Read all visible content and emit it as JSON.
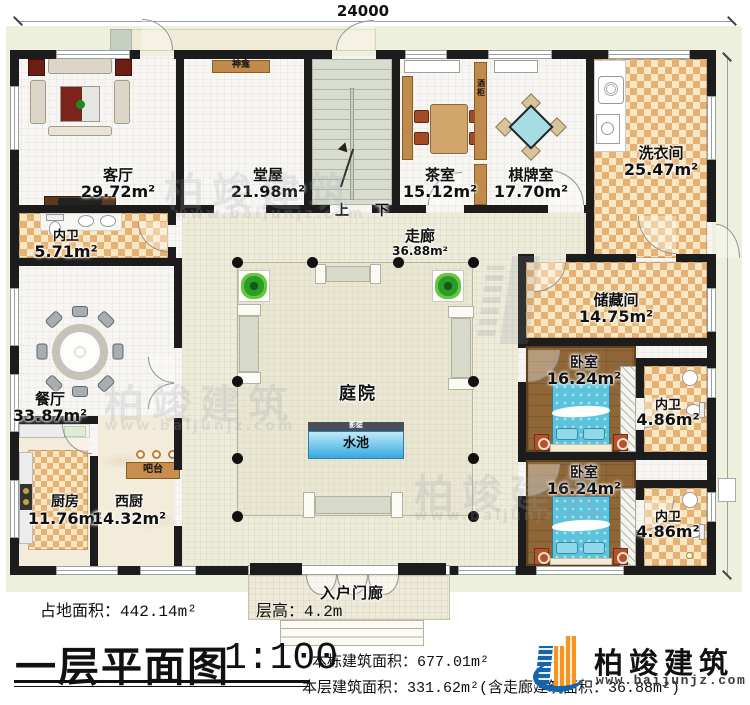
{
  "dimensions": {
    "top": "24000",
    "right": "18000"
  },
  "stair": {
    "up": "上",
    "down": "下"
  },
  "fixtures": {
    "shrine": "神龛",
    "wine_cabinet": "酒柜",
    "bar": "吧台",
    "screen_wall": "影壁"
  },
  "rooms": {
    "living": {
      "name": "客厅",
      "area": "29.72m²"
    },
    "hall": {
      "name": "堂屋",
      "area": "21.98m²"
    },
    "tea": {
      "name": "茶室",
      "area": "15.12m²"
    },
    "chess": {
      "name": "棋牌室",
      "area": "17.70m²"
    },
    "laundry": {
      "name": "洗衣间",
      "area": "25.47m²"
    },
    "bath_tl": {
      "name": "内卫",
      "area": "5.71m²"
    },
    "corridor": {
      "name": "走廊",
      "area": "36.88m²"
    },
    "dining": {
      "name": "餐厅",
      "area": "33.87m²"
    },
    "kitchen": {
      "name": "厨房",
      "area": "11.76m²"
    },
    "west_kitchen": {
      "name": "西厨",
      "area": "14.32m²"
    },
    "storage": {
      "name": "储藏间",
      "area": "14.75m²"
    },
    "bedroom1": {
      "name": "卧室",
      "area": "16.24m²"
    },
    "bath1": {
      "name": "内卫",
      "area": "4.86m²"
    },
    "bedroom2": {
      "name": "卧室",
      "area": "16.24m²"
    },
    "bath2": {
      "name": "内卫",
      "area": "4.86m²"
    },
    "courtyard": {
      "name": "庭院"
    },
    "pool": {
      "name": "水池"
    },
    "porch": {
      "name": "入户门廊"
    }
  },
  "footer": {
    "site_area": "占地面积：442.14m²",
    "floor_height": "层高：4.2m",
    "title": "一层平面图",
    "scale": "1:100",
    "building_area": "本栋建筑面积：677.01m²",
    "floor_area": "本层建筑面积：331.62m²(含走廊建筑面积：36.88m²)"
  },
  "brand": {
    "name": "柏竣建筑",
    "site": "www.baijunjz.com"
  },
  "watermark": {
    "name": "柏竣建筑",
    "site": "www.baijunjz.com"
  },
  "colors": {
    "wall": "#1c1c1c",
    "checker_tan": "#e7b271",
    "wood_floor": "#8e6637",
    "pool_blue": "#45b5e2",
    "bed_blue": "#5cc3dc",
    "brand_blue": "#1565ad",
    "brand_orange": "#f7941d",
    "ground": "#eef0de",
    "corridor_floor": "#edebd9"
  }
}
